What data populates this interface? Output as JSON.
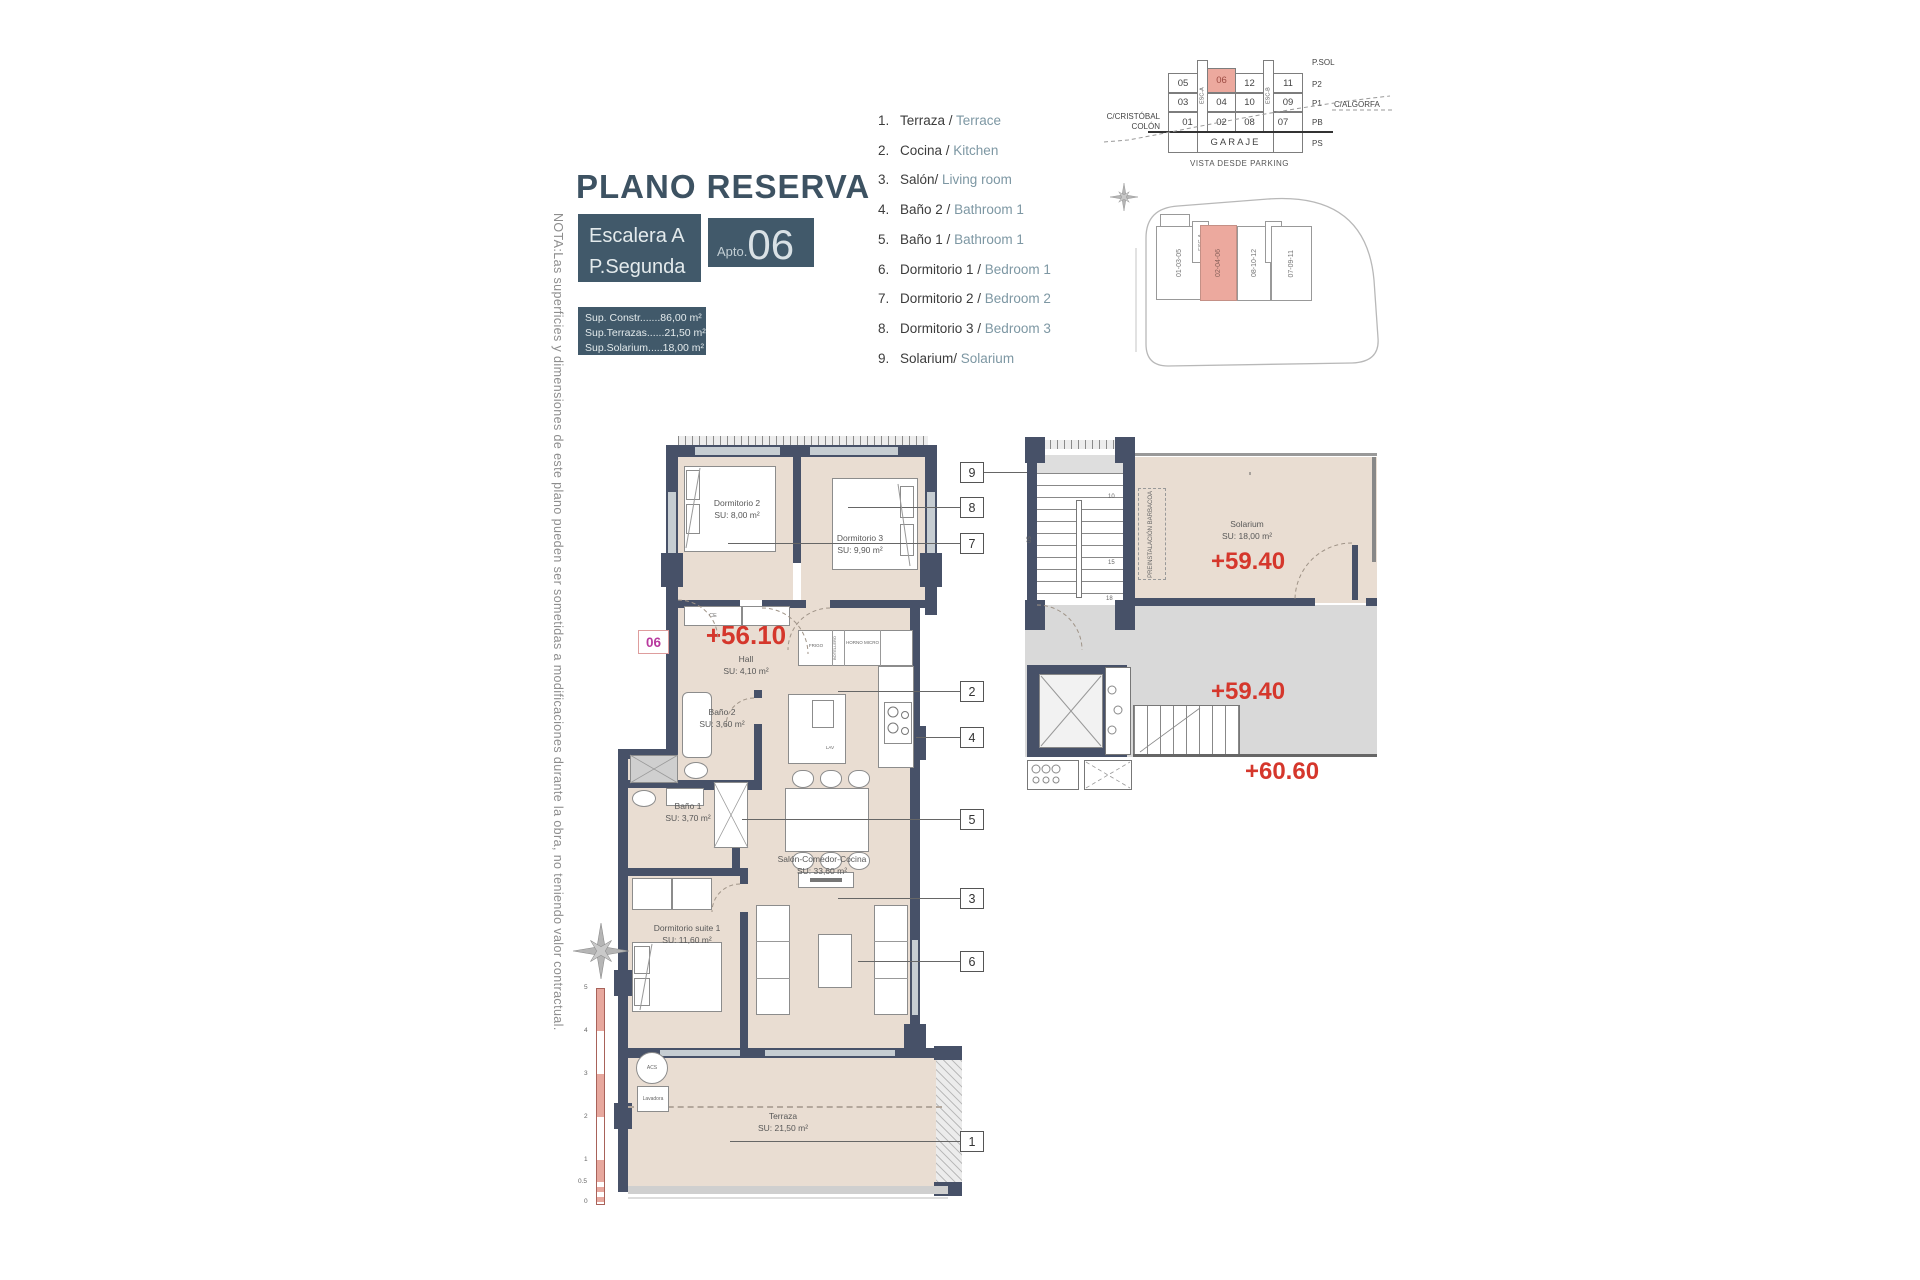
{
  "note": "NOTA:Las superficies y dimensiones de este plano pueden ser sometidas a modificaciones durante la obra, no teniendo valor contractual.",
  "header": {
    "title": "PLANO RESERVA",
    "stair": "Escalera A",
    "floor": "P.Segunda",
    "apto_label": "Apto.",
    "apto_number": "06",
    "sup_lines": [
      "Sup. Constr.......86,00 m²",
      "Sup.Terrazas......21,50 m²",
      "Sup.Solarium.....18,00 m²"
    ]
  },
  "legend": {
    "items": [
      {
        "num": "1.",
        "es": "Terraza /",
        "en": "Terrace"
      },
      {
        "num": "2.",
        "es": "Cocina /",
        "en": "Kitchen"
      },
      {
        "num": "3.",
        "es": "Salón/",
        "en": "Living room"
      },
      {
        "num": "4.",
        "es": "Baño 2 /",
        "en": "Bathroom 1"
      },
      {
        "num": "5.",
        "es": "Baño 1 /",
        "en": "Bathroom 1"
      },
      {
        "num": "6.",
        "es": "Dormitorio 1 /",
        "en": "Bedroom 1"
      },
      {
        "num": "7.",
        "es": "Dormitorio 2 /",
        "en": "Bedroom 2"
      },
      {
        "num": "8.",
        "es": "Dormitorio 3 /",
        "en": "Bedroom 3"
      },
      {
        "num": "9.",
        "es": "Solarium/",
        "en": "Solarium"
      }
    ]
  },
  "elevation": {
    "r1": [
      "05",
      "06",
      "12",
      "11"
    ],
    "r2": [
      "03",
      "04",
      "10",
      "09"
    ],
    "r3": [
      "01",
      "02",
      "08",
      "07"
    ],
    "garaje": "GARAJE",
    "esc_a": "ESC-A",
    "esc_b": "ESC-B",
    "levels": [
      "P.SOL",
      "P2",
      "P1",
      "PB",
      "PS"
    ],
    "street_left": "C/CRISTÓBAL COLÓN",
    "street_right": "C/ALGORFA",
    "caption": "VISTA DESDE PARKING"
  },
  "site": {
    "sections": [
      "01-03-05",
      "ESC-A",
      "02-04-06",
      "08-10-12",
      "ESC-B",
      "07-09-11"
    ]
  },
  "plan": {
    "badge": "06",
    "level_hall": "+56.10",
    "rooms": {
      "dorm2": {
        "name": "Dormitorio 2",
        "area": "SU: 8,00 m²"
      },
      "dorm3": {
        "name": "Dormitorio 3",
        "area": "SU: 9,90 m²"
      },
      "hall": {
        "name": "Hall",
        "area": "SU: 4,10 m²"
      },
      "bano2": {
        "name": "Baño 2",
        "area": "SU: 3,60 m²"
      },
      "bano1": {
        "name": "Baño 1",
        "area": "SU: 3,70 m²"
      },
      "salon": {
        "name": "Salón-Comedor-Cocina",
        "area": "SU: 33,60 m²"
      },
      "suite": {
        "name": "Dormitorio suite 1",
        "area": "SU: 11,60 m²"
      },
      "terraza": {
        "name": "Terraza",
        "area": "SU: 21,50 m²"
      },
      "solarium": {
        "name": "Solarium",
        "area": "SU: 18,00 m²"
      }
    },
    "labels": {
      "ce": "CE",
      "frigo": "FRIGO",
      "horno": "HORNO MICRO",
      "botellero": "BOTELLERO",
      "lav": "LAV",
      "acs": "ACS",
      "lavadora": "Lavadora"
    }
  },
  "solarium_plan": {
    "barbacoa": "PREINSTALACIÓN BARBACOA",
    "level_upper": "+59.40",
    "level_mid": "+59.40",
    "level_lower": "+60.60",
    "stair_marks": [
      "10",
      "15",
      "18",
      "05"
    ]
  },
  "refs": [
    "9",
    "8",
    "7",
    "2",
    "4",
    "5",
    "3",
    "6",
    "1"
  ],
  "scalebar": [
    "5",
    "4",
    "3",
    "2",
    "1",
    "0.5",
    "0"
  ]
}
